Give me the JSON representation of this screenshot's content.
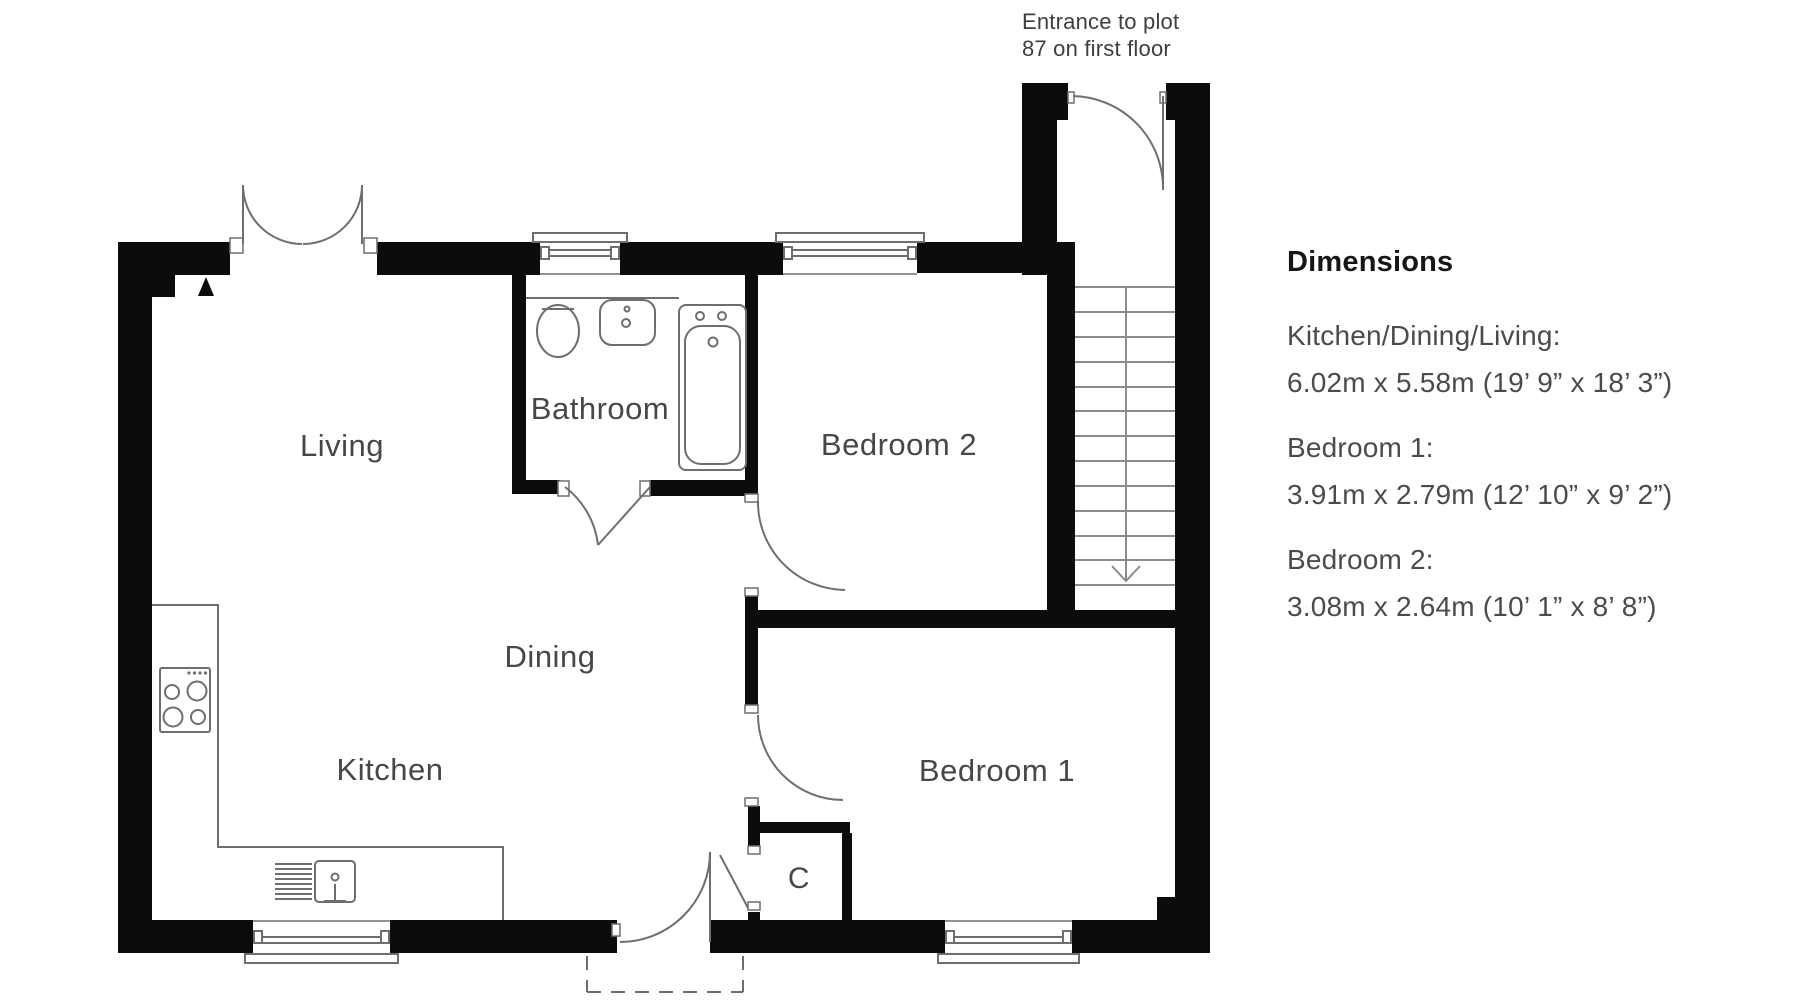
{
  "annotation": {
    "line1": "Entrance to plot",
    "line2": "87 on first floor"
  },
  "rooms": {
    "living": "Living",
    "bathroom": "Bathroom",
    "bedroom2": "Bedroom 2",
    "dining": "Dining",
    "kitchen": "Kitchen",
    "bedroom1": "Bedroom 1",
    "cupboard": "C"
  },
  "dimensions_panel": {
    "heading": "Dimensions",
    "entries": [
      {
        "label": "Kitchen/Dining/Living:",
        "value": "6.02m x 5.58m (19’ 9” x 18’ 3”)"
      },
      {
        "label": "Bedroom 1:",
        "value": "3.91m x 2.79m (12’ 10” x 9’ 2”)"
      },
      {
        "label": "Bedroom 2:",
        "value": "3.08m x 2.64m (10’ 1” x 8’ 8”)"
      }
    ]
  },
  "colors": {
    "wall": "#0c0c0c",
    "line": "#6e6e6e",
    "stair_line": "#8c8c8c",
    "text": "#474747"
  }
}
